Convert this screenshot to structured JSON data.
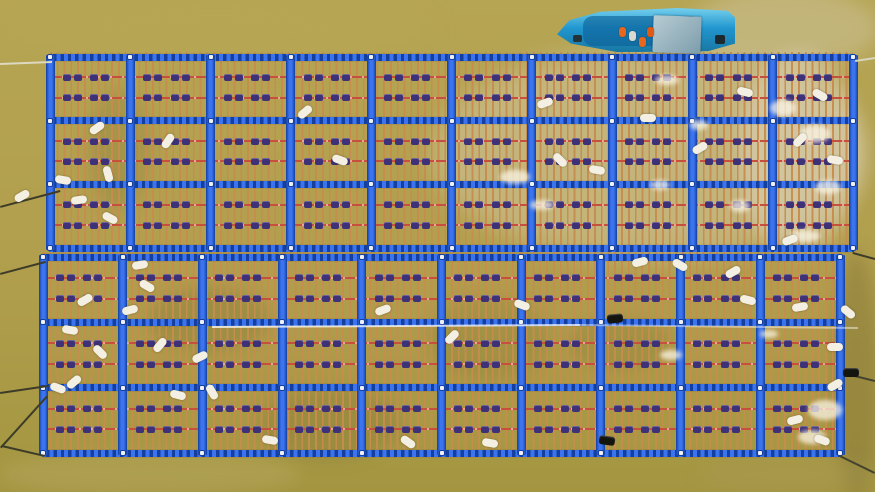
{
  "caption": "Aerial drone view of two large floating oyster-farming rafts with blue plastic frames and orange rope curtains on muddy khaki river water; a blue work boat with crew in orange life vests is moored at the top edge",
  "scene": {
    "width": 875,
    "height": 492,
    "water": {
      "base_top": "#b6a553",
      "base_mid": "#b19f4d",
      "base_bottom": "#a49641",
      "patches": [
        [
          430,
          48,
          440,
          212,
          "rgba(214,203,178,0.45)",
          12
        ],
        [
          688,
          -12,
          192,
          82,
          "rgba(208,197,162,0.5)",
          10
        ],
        [
          738,
          52,
          122,
          202,
          "rgba(224,214,194,0.5)",
          8
        ],
        [
          833,
          250,
          46,
          250,
          "rgba(124,110,52,0.4)",
          8
        ],
        [
          0,
          0,
          430,
          58,
          "rgba(186,172,88,0.3)",
          14
        ],
        [
          148,
          288,
          122,
          62,
          "rgba(70,70,35,0.16)",
          7
        ],
        [
          258,
          388,
          142,
          72,
          "rgba(70,70,35,0.14)",
          8
        ],
        [
          428,
          298,
          122,
          82,
          "rgba(70,70,35,0.12)",
          8
        ],
        [
          88,
          88,
          62,
          122,
          "rgba(70,70,35,0.14)",
          8
        ],
        [
          568,
          318,
          102,
          52,
          "rgba(70,70,35,0.12)",
          6
        ],
        [
          0,
          453,
          300,
          42,
          "rgba(192,180,112,0.3)",
          8
        ],
        [
          700,
          455,
          175,
          40,
          "rgba(172,157,92,0.3)",
          8
        ]
      ]
    },
    "raft_style": {
      "frame": "#1d50c6",
      "frame_light": "#3b74ee",
      "frame_dark": "#143f9f",
      "rope": "#c78c4f",
      "rope_width": 1.8,
      "rope_spacing": 6.8,
      "rope_overhang": 5,
      "bar_h": 7,
      "post_w": 9,
      "line": "#c6503c",
      "line_fractions": [
        0.32,
        0.64
      ],
      "cluster": "#3d3277",
      "cluster_fractions": [
        0.28,
        0.62
      ],
      "dot": "#eef1f8"
    },
    "rafts": [
      {
        "x": 50,
        "y": 57,
        "w": 803,
        "h": 191,
        "cols": 10,
        "rows": 3
      },
      {
        "x": 43,
        "y": 257,
        "w": 797,
        "h": 196,
        "cols": 10,
        "rows": 3
      }
    ],
    "buoys": {
      "color": "#f3f0e3",
      "items": [
        [
          97,
          128,
          -35
        ],
        [
          63,
          180,
          10
        ],
        [
          108,
          174,
          75
        ],
        [
          79,
          200,
          -8
        ],
        [
          110,
          218,
          28
        ],
        [
          168,
          141,
          -55
        ],
        [
          305,
          112,
          -40
        ],
        [
          340,
          160,
          20
        ],
        [
          545,
          103,
          -20
        ],
        [
          560,
          160,
          45
        ],
        [
          597,
          170,
          10
        ],
        [
          648,
          118,
          0
        ],
        [
          700,
          148,
          -30
        ],
        [
          745,
          92,
          15
        ],
        [
          800,
          140,
          -45
        ],
        [
          820,
          95,
          30
        ],
        [
          835,
          160,
          10
        ],
        [
          790,
          240,
          -20
        ],
        [
          22,
          196,
          -30
        ],
        [
          85,
          300,
          -30
        ],
        [
          70,
          330,
          10
        ],
        [
          100,
          352,
          45
        ],
        [
          130,
          310,
          -15
        ],
        [
          147,
          286,
          30
        ],
        [
          160,
          345,
          -50
        ],
        [
          178,
          395,
          15
        ],
        [
          200,
          357,
          -25
        ],
        [
          212,
          392,
          60
        ],
        [
          140,
          265,
          -10
        ],
        [
          58,
          388,
          20
        ],
        [
          74,
          382,
          -40
        ],
        [
          270,
          440,
          10
        ],
        [
          383,
          310,
          -20
        ],
        [
          408,
          442,
          35
        ],
        [
          452,
          337,
          -45
        ],
        [
          490,
          443,
          10
        ],
        [
          522,
          305,
          20
        ],
        [
          640,
          262,
          -15
        ],
        [
          680,
          265,
          30
        ],
        [
          733,
          272,
          -30
        ],
        [
          748,
          300,
          15
        ],
        [
          800,
          307,
          -10
        ],
        [
          848,
          312,
          40
        ],
        [
          835,
          347,
          0
        ],
        [
          835,
          385,
          -30
        ],
        [
          822,
          440,
          20
        ],
        [
          795,
          420,
          -15
        ]
      ]
    },
    "black_floats": [
      [
        615,
        318,
        -5
      ],
      [
        607,
        440,
        8
      ],
      [
        851,
        372,
        0
      ]
    ],
    "debris": {
      "color": "rgba(250,245,230,0.75)",
      "items": [
        [
          500,
          170,
          30,
          14
        ],
        [
          530,
          200,
          24,
          10
        ],
        [
          770,
          100,
          26,
          16
        ],
        [
          800,
          125,
          30,
          18
        ],
        [
          815,
          180,
          26,
          14
        ],
        [
          790,
          230,
          30,
          12
        ],
        [
          650,
          180,
          20,
          10
        ],
        [
          690,
          120,
          18,
          10
        ],
        [
          808,
          400,
          34,
          20
        ],
        [
          798,
          430,
          28,
          14
        ],
        [
          660,
          350,
          22,
          10
        ],
        [
          760,
          330,
          18,
          8
        ],
        [
          655,
          75,
          24,
          10
        ],
        [
          730,
          200,
          20,
          12
        ]
      ]
    },
    "anchor_lines": [
      {
        "x1": 0,
        "y1": 63,
        "x2": 52,
        "y2": 61,
        "color": "#ddd8c0"
      },
      {
        "x1": 0,
        "y1": 206,
        "x2": 60,
        "y2": 190,
        "color": "#3c3c28"
      },
      {
        "x1": 0,
        "y1": 273,
        "x2": 45,
        "y2": 261,
        "color": "#3c3c28"
      },
      {
        "x1": 0,
        "y1": 392,
        "x2": 48,
        "y2": 385,
        "color": "#3c3c28"
      },
      {
        "x1": 0,
        "y1": 447,
        "x2": 46,
        "y2": 396,
        "color": "#3c3c28"
      },
      {
        "x1": 2,
        "y1": 445,
        "x2": 45,
        "y2": 455,
        "color": "#3c3c28"
      },
      {
        "x1": 853,
        "y1": 252,
        "x2": 875,
        "y2": 258,
        "color": "#3c3c28"
      },
      {
        "x1": 840,
        "y1": 455,
        "x2": 875,
        "y2": 472,
        "color": "#44442e"
      },
      {
        "x1": 851,
        "y1": 374,
        "x2": 875,
        "y2": 380,
        "color": "#44442e"
      },
      {
        "x1": 855,
        "y1": 60,
        "x2": 875,
        "y2": 57,
        "color": "#d8d4bc"
      },
      {
        "x1": 212,
        "y1": 326,
        "x2": 580,
        "y2": 324,
        "color": "rgba(255,255,255,0.75)"
      },
      {
        "x1": 580,
        "y1": 324,
        "x2": 858,
        "y2": 327,
        "color": "rgba(255,255,255,0.45)"
      }
    ],
    "boat": {
      "x": 557,
      "y": 7,
      "w": 178,
      "h": 47,
      "hull_clip": "polygon(0% 58%, 7% 28%, 24% 10%, 68% 2%, 96% 8%, 100% 22%, 100% 78%, 85% 94%, 34% 96%, 8% 78%)",
      "hull_top": "#79d2ee",
      "hull_mid": "#2196cf",
      "hull_bottom": "#18759f",
      "deck_color": "rgba(12,95,150,0.6)",
      "canopy": {
        "x": 96,
        "y": 9,
        "w": 48,
        "h": 37,
        "color1": "#b7ccd4",
        "color2": "#7d9dab",
        "rot": 2
      },
      "people": [
        {
          "x": 62,
          "y": 20,
          "c": "#e8671c"
        },
        {
          "x": 72,
          "y": 24,
          "c": "#d9d9d2"
        },
        {
          "x": 82,
          "y": 30,
          "c": "#e8671c"
        },
        {
          "x": 90,
          "y": 20,
          "c": "#e05a14"
        }
      ],
      "motor": {
        "x": 158,
        "y": 28,
        "w": 10,
        "h": 9,
        "c": "#1c2a30"
      },
      "bow_fitting": {
        "x": 16,
        "y": 28,
        "w": 9,
        "h": 7,
        "c": "#24323a"
      }
    }
  }
}
